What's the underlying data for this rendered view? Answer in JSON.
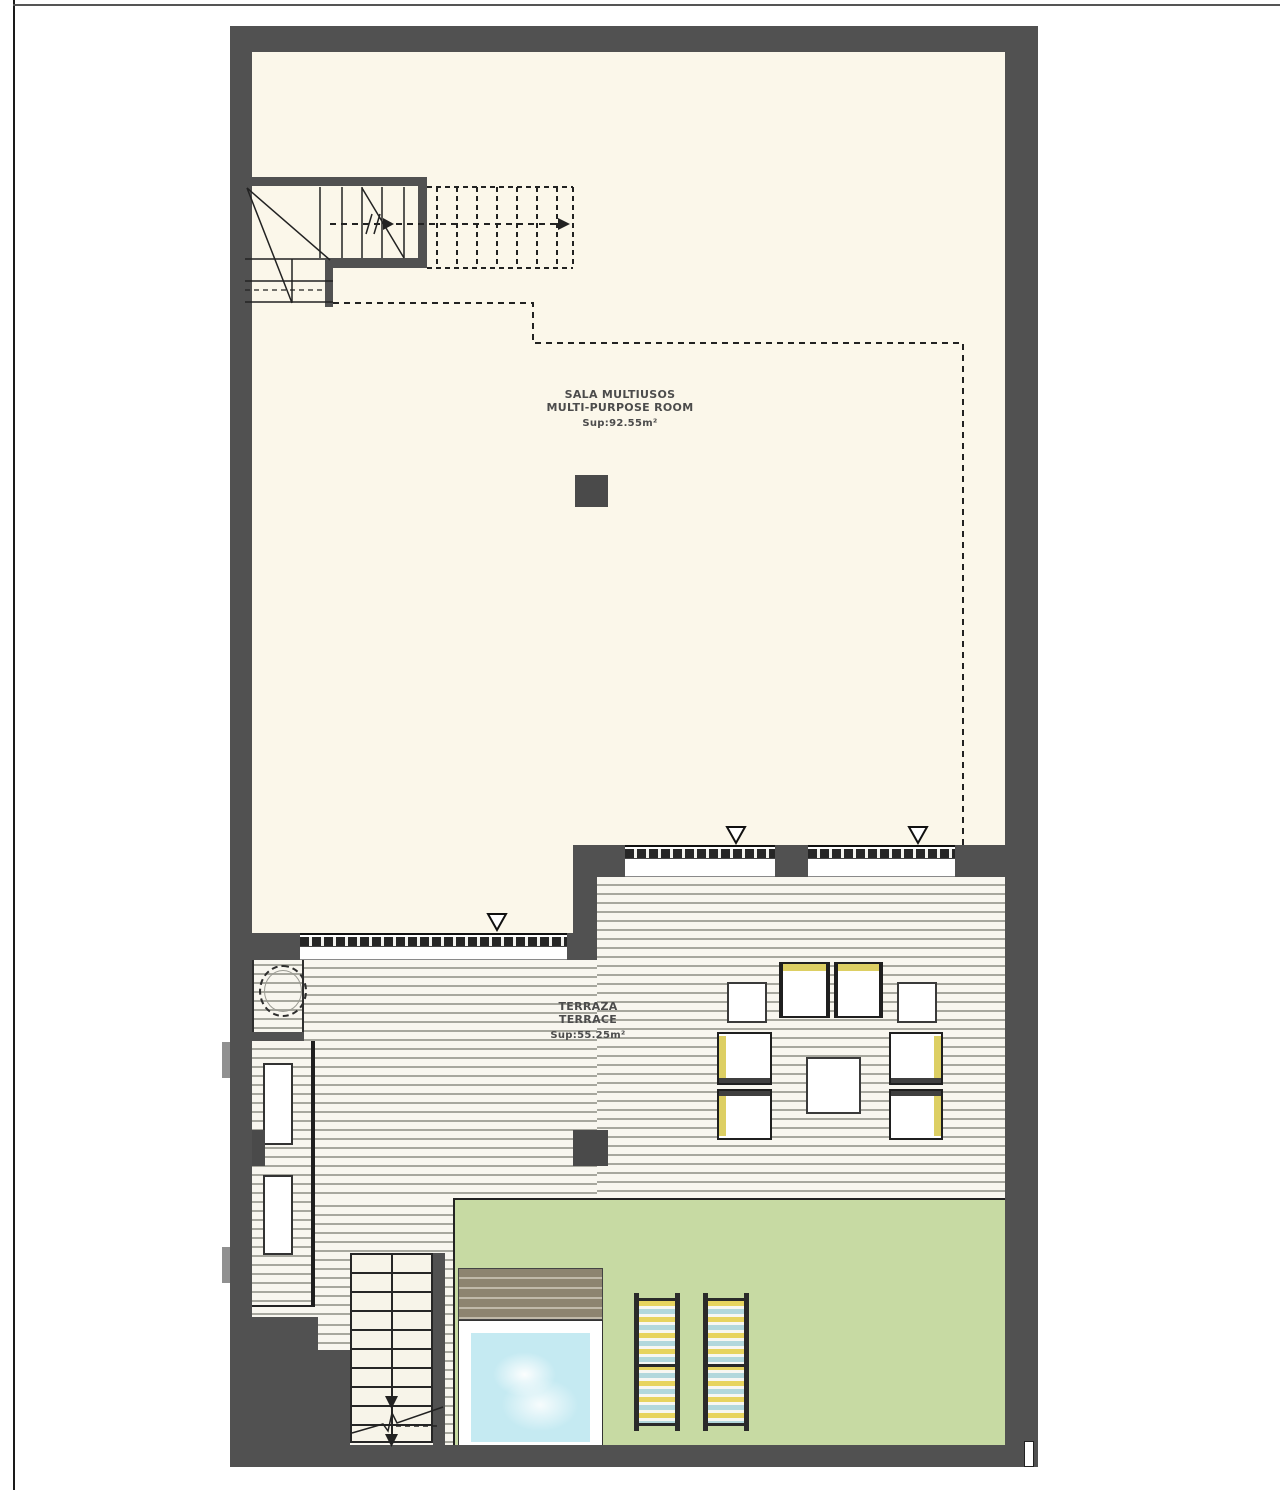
{
  "plan": {
    "rooms": [
      {
        "id": "multi-purpose-room",
        "name_es": "SALA MULTIUSOS",
        "name_en": "MULTI-PURPOSE ROOM",
        "area_label": "Sup:92.55m²"
      },
      {
        "id": "terrace",
        "name_es": "TERRAZA",
        "name_en": "TERRACE",
        "area_label": "Sup:55.25m²"
      }
    ],
    "colors": {
      "wall": "#515151",
      "room_floor": "#fbf7ea",
      "deck_background": "#f8f6ef",
      "deck_line": "#a7a79e",
      "lawn": "#c7daa3",
      "pool_water": "#c5eaf2",
      "pool_deck_dark": "#8d8470",
      "pool_deck_light": "#c0b9a9",
      "cushion_yellow": "#ddcf63",
      "lounger_yellow": "#e7d45f",
      "lounger_blue": "#b2d8dc",
      "drawing_line": "#222222",
      "label_text": "#4c4c4c"
    }
  }
}
